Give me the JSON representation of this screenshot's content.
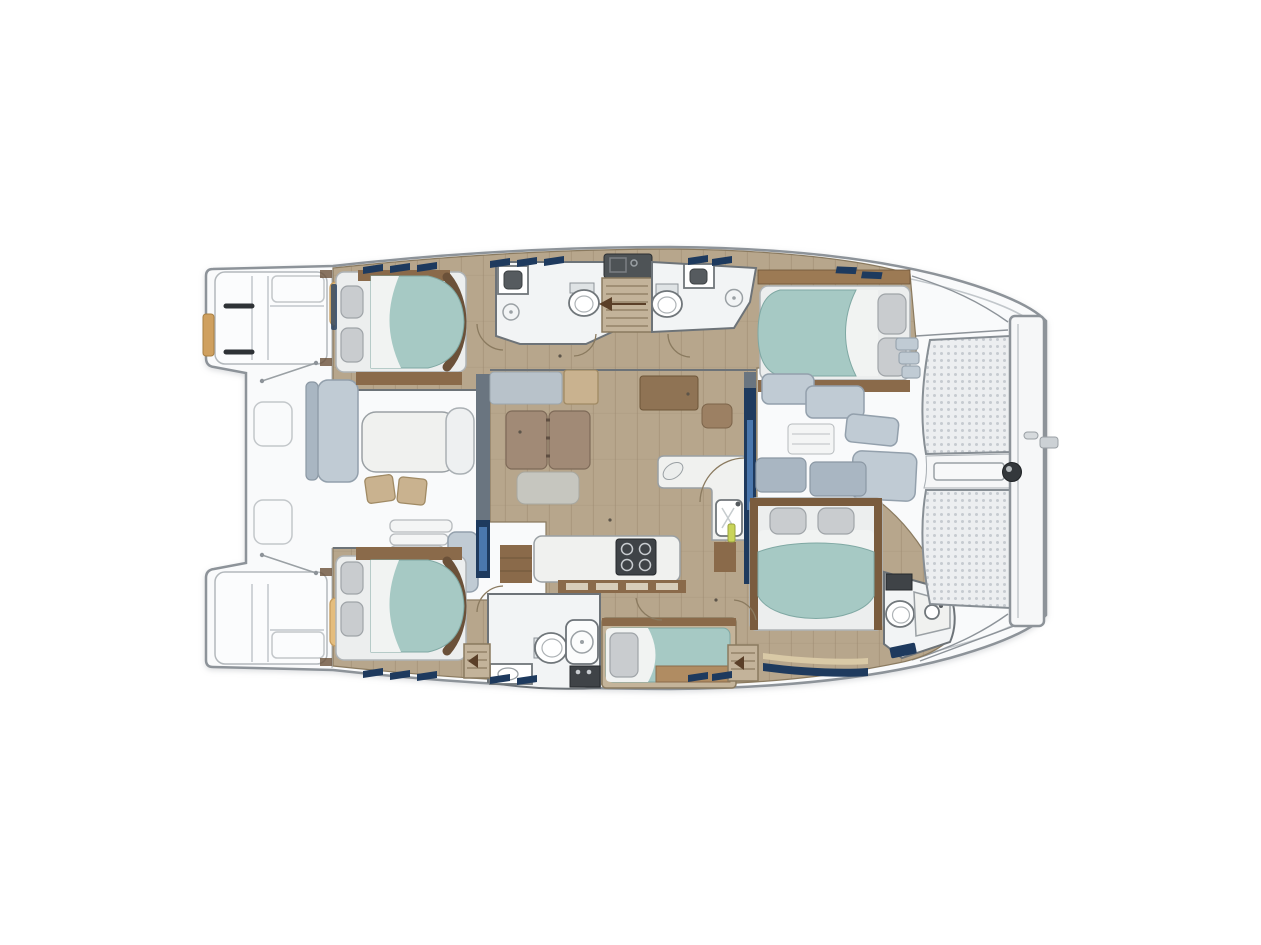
{
  "meta": {
    "title": "Catamaran yacht accommodation plan — top view, bow to the right",
    "type": "floor-plan",
    "visible_text": "",
    "orientation": {
      "bow": "right",
      "stern": "left"
    }
  },
  "counts": {
    "double_cabins": 4,
    "single_berths": 1,
    "heads": 4,
    "toilets": 4,
    "showers": 3,
    "trampoline_panels": 2,
    "cockpit_chairs": 2,
    "cooktop_burners": 4
  },
  "palette": {
    "background": "#ffffff",
    "hull_fill": "#f9fafb",
    "hull_line": "#8d9399",
    "toe_rail": "#c2c7cb",
    "wood_floor": "#b7a68c",
    "wood_plank": "#a08e74",
    "wood_trim": "#8a6a4a",
    "wood_trim_dark": "#6b5139",
    "mattress_teal": "#a6c9c4",
    "mattress_edge": "#7fa8a3",
    "linen_white": "#f1f3f2",
    "pillow_gray": "#c9cccf",
    "seat_gray": "#c0cbd4",
    "seat_gray_deep": "#a9b6c2",
    "cushion_brown": "#a18a76",
    "ottoman_gray": "#c6c6bf",
    "chair_tan": "#c9b28f",
    "pad_tan": "#e4bd7e",
    "counter_white": "#f0f1ef",
    "appliance_dark": "#3f4347",
    "navy_accent": "#1e3a5e",
    "glass_blue": "#4a77ad",
    "room_white": "#f2f4f5",
    "wall_line": "#6d7378",
    "stair_wood": "#c3b39a",
    "mesh_fill": "#eceef0",
    "mesh_dot": "#c6cbd0",
    "arc_brown": "#8a7a5f"
  },
  "regions": {
    "hull": {
      "label": "Catamaran twin-hull deck outline"
    },
    "port_transom": {
      "label": "Port swim platform with steps"
    },
    "starboard_transom": {
      "label": "Starboard swim platform with steps"
    },
    "swim_ladder": {
      "label": "Boarding ladder"
    },
    "boarding_handles": {
      "label": "Transom grab handles"
    },
    "aft_cockpit": {
      "label": "Aft cockpit"
    },
    "cockpit_table": {
      "label": "Cockpit dining table"
    },
    "cockpit_bench": {
      "label": "Cockpit bench seat"
    },
    "cockpit_chairs": {
      "label": "Folding deck chairs"
    },
    "cockpit_side_seat": {
      "label": "Curved cockpit seat"
    },
    "cockpit_steps": {
      "label": "Moulded cockpit steps"
    },
    "cockpit_seat_module": {
      "label": "Aft cockpit seat module"
    },
    "deck_pads": {
      "label": "Stowage pads"
    },
    "deck_hatches": {
      "label": "Deck locker hatches"
    },
    "davits": {
      "label": "Dinghy davit lines"
    },
    "aft_door": {
      "label": "Sliding door — salon to aft cockpit"
    },
    "salon": {
      "label": "Salon"
    },
    "salon_settee": {
      "label": "Salon settee backrest"
    },
    "salon_table": {
      "label": "Folding salon table with twin leaves"
    },
    "salon_ottoman": {
      "label": "Salon bench ottoman"
    },
    "nav_station": {
      "label": "Navigation station with seat"
    },
    "galley": {
      "label": "Galley"
    },
    "galley_island": {
      "label": "Galley island worktop"
    },
    "cooktop": {
      "label": "Four-burner cooktop"
    },
    "galley_sink": {
      "label": "Galley sink"
    },
    "galley_cabinets": {
      "label": "Galley stowage cabinets"
    },
    "fwd_door": {
      "label": "Sliding door — salon to forward cockpit"
    },
    "fwd_cockpit": {
      "label": "Forward cockpit lounge seating"
    },
    "port_aft_cabin": {
      "label": "Port aft double cabin"
    },
    "port_aft_head": {
      "label": "Port aft head — toilet, basin, shower"
    },
    "port_stairs": {
      "label": "Port hull companionway steps"
    },
    "galley_up_unit": {
      "label": "Worktop unit with sink at companionway"
    },
    "port_fwd_head": {
      "label": "Port forward head — toilet, basin, shower"
    },
    "port_fwd_cabin": {
      "label": "Port forward double cabin"
    },
    "stbd_aft_cabin": {
      "label": "Starboard aft double cabin"
    },
    "stbd_head": {
      "label": "Starboard head — toilet, shower stall, basin"
    },
    "single_berth": {
      "label": "Single berth bunk"
    },
    "stbd_stairs": {
      "label": "Starboard hull companionway steps"
    },
    "stbd_fwd_cabin": {
      "label": "Starboard forward double cabin"
    },
    "stbd_fwd_head": {
      "label": "Starboard forward head — toilet and basin"
    },
    "trampoline": {
      "label": "Bow trampoline nets"
    },
    "bow_beam": {
      "label": "Forward crossbeam"
    },
    "forestay_fitting": {
      "label": "Forestay fitting"
    },
    "windlass": {
      "label": "Windlass / beam knob"
    },
    "hull_windows": {
      "label": "Hull window accents"
    },
    "door_arcs": {
      "label": "Door swing arcs"
    }
  }
}
